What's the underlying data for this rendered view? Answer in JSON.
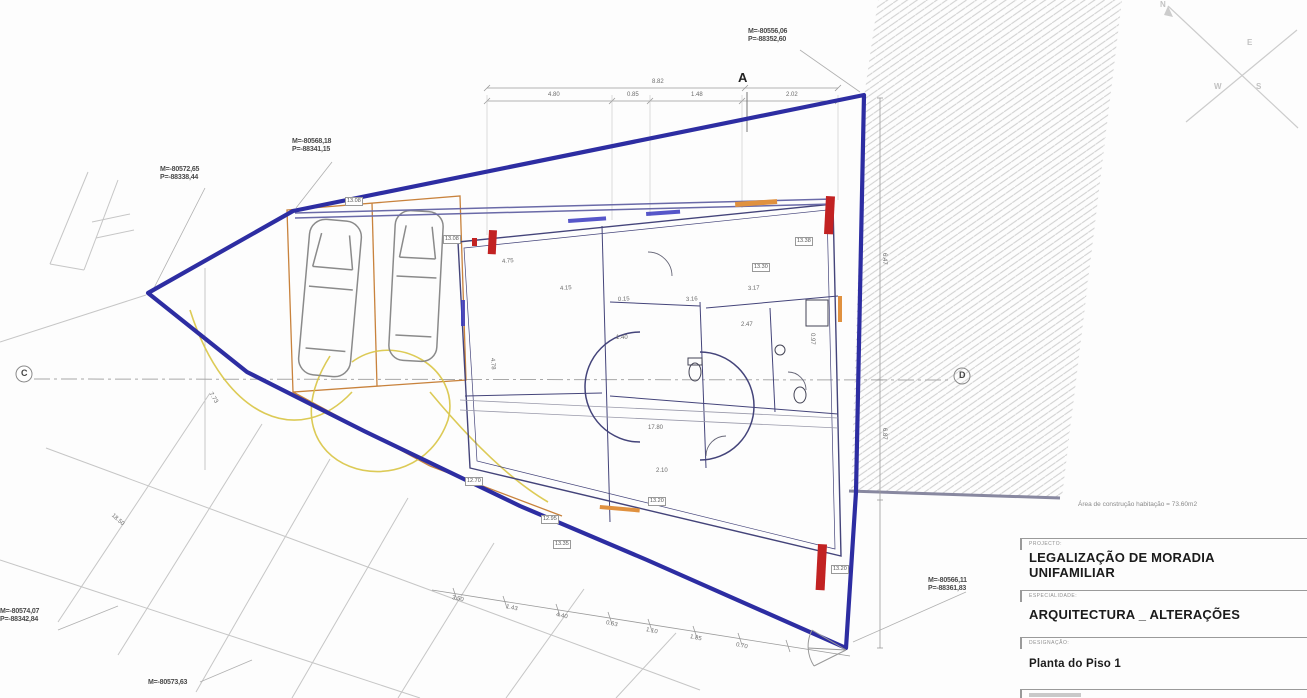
{
  "colors": {
    "boundary_blue": "#2d2da2",
    "wall_blue": "#44447a",
    "section_red": "#c22222",
    "garage_orange": "#c8823c",
    "path_yellow": "#d9c544",
    "hatch_gray": "#cfcfcf"
  },
  "title_block": {
    "project_label": "PROJECTO:",
    "project_title_line1": "LEGALIZAÇÃO DE MORADIA",
    "project_title_line2": "UNIFAMILIAR",
    "specialty_label": "ESPECIALIDADE:",
    "specialty_title": "ARQUITECTURA _ ALTERAÇÕES",
    "designation_label": "DESIGNAÇÃO:",
    "designation_title": "Planta do Piso 1"
  },
  "area_note": "Área de construção habitação = 73.60m2",
  "compass": {
    "n": "N",
    "e": "E",
    "s": "S",
    "w": "W"
  },
  "section_markers": {
    "a": "A",
    "c": "C",
    "d": "D"
  },
  "coordinates": [
    {
      "m": "M=-80556,06",
      "p": "P=-88352,60",
      "x": 748,
      "y": 28
    },
    {
      "m": "M=-80568,18",
      "p": "P=-88341,15",
      "x": 292,
      "y": 138
    },
    {
      "m": "M=-80572,65",
      "p": "P=-88338,44",
      "x": 160,
      "y": 166
    },
    {
      "m": "M=-80566,11",
      "p": "P=-88361,83",
      "x": 928,
      "y": 577
    },
    {
      "m": "M=-80574,07",
      "p": "P=-88342,84",
      "x": 0,
      "y": 608
    },
    {
      "m": "M=-80573,63",
      "p": "",
      "x": 148,
      "y": 679
    }
  ],
  "dimensions": [
    {
      "t": "8.82",
      "x": 652,
      "y": 79,
      "r": 0
    },
    {
      "t": "4.80",
      "x": 548,
      "y": 92,
      "r": 0
    },
    {
      "t": "0.85",
      "x": 627,
      "y": 92,
      "r": 0
    },
    {
      "t": "1.48",
      "x": 691,
      "y": 92,
      "r": 0
    },
    {
      "t": "2.02",
      "x": 786,
      "y": 92,
      "r": 0
    },
    {
      "t": "6.47",
      "x": 884,
      "y": 250,
      "r": 90
    },
    {
      "t": "6.87",
      "x": 884,
      "y": 425,
      "r": 90
    },
    {
      "t": "0.97",
      "x": 812,
      "y": 330,
      "r": 90
    },
    {
      "t": "4.78",
      "x": 492,
      "y": 355,
      "r": 86
    },
    {
      "t": "4.15",
      "x": 560,
      "y": 286,
      "r": -4
    },
    {
      "t": "4.75",
      "x": 502,
      "y": 259,
      "r": -4
    },
    {
      "t": "0.15",
      "x": 618,
      "y": 297,
      "r": -3
    },
    {
      "t": "3.16",
      "x": 686,
      "y": 297,
      "r": -3
    },
    {
      "t": "3.17",
      "x": 748,
      "y": 286,
      "r": -3
    },
    {
      "t": "2.47",
      "x": 741,
      "y": 322,
      "r": 0
    },
    {
      "t": "1.40",
      "x": 616,
      "y": 335,
      "r": 0
    },
    {
      "t": "2.10",
      "x": 656,
      "y": 468,
      "r": 0
    },
    {
      "t": "17.80",
      "x": 648,
      "y": 425,
      "r": 0
    },
    {
      "t": "3.50",
      "x": 452,
      "y": 595,
      "r": 12
    },
    {
      "t": "1.43",
      "x": 506,
      "y": 604,
      "r": 12
    },
    {
      "t": "4.40",
      "x": 556,
      "y": 612,
      "r": 12
    },
    {
      "t": "0.63",
      "x": 606,
      "y": 620,
      "r": 12
    },
    {
      "t": "1.10",
      "x": 646,
      "y": 627,
      "r": 12
    },
    {
      "t": "1.85",
      "x": 690,
      "y": 634,
      "r": 12
    },
    {
      "t": "0.70",
      "x": 736,
      "y": 642,
      "r": 12
    },
    {
      "t": "7.73",
      "x": 210,
      "y": 390,
      "r": 58
    },
    {
      "t": "18.50",
      "x": 112,
      "y": 512,
      "r": 42
    }
  ],
  "levels": [
    {
      "t": "13.08",
      "x": 345,
      "y": 197
    },
    {
      "t": "13.08",
      "x": 443,
      "y": 235
    },
    {
      "t": "13.30",
      "x": 752,
      "y": 263
    },
    {
      "t": "13.38",
      "x": 795,
      "y": 237
    },
    {
      "t": "12.70",
      "x": 465,
      "y": 477
    },
    {
      "t": "12.95",
      "x": 541,
      "y": 515
    },
    {
      "t": "13.35",
      "x": 553,
      "y": 540
    },
    {
      "t": "13.20",
      "x": 648,
      "y": 497
    },
    {
      "t": "13.20",
      "x": 831,
      "y": 565
    }
  ]
}
